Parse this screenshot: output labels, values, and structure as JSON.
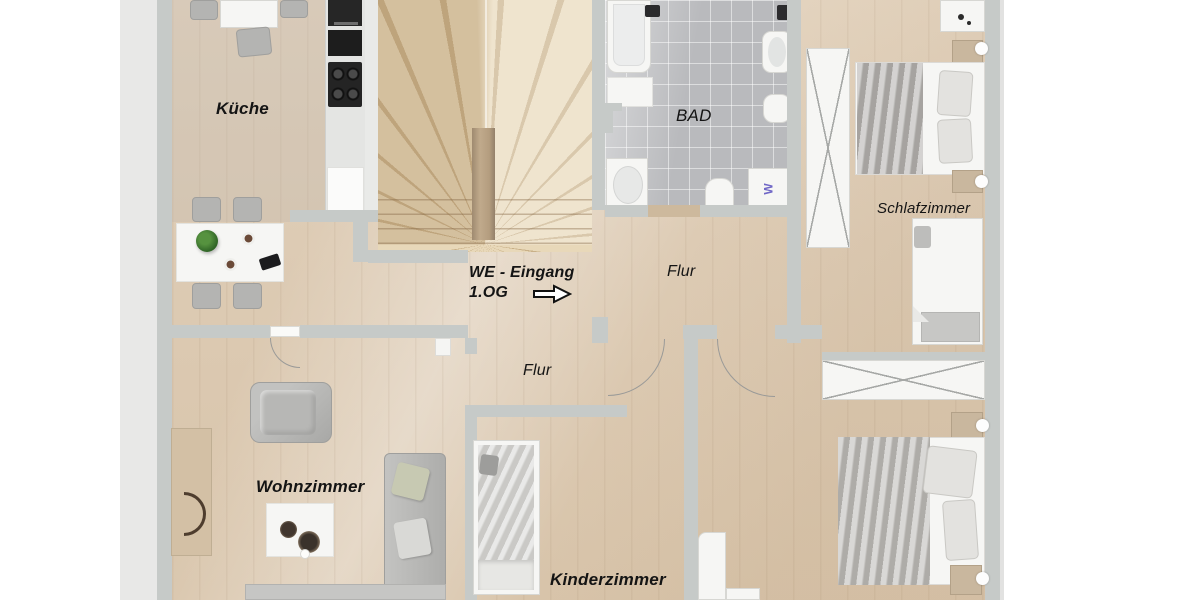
{
  "plan": {
    "type": "apartment-floor-plan",
    "labels": {
      "kueche": "Küche",
      "bad": "BAD",
      "flur_upper": "Flur",
      "flur_lower": "Flur",
      "schlafzimmer": "Schlafzimmer",
      "wohnzimmer": "Wohnzimmer",
      "kinderzimmer": "Kinderzimmer",
      "entrance_line1": "WE - Eingang",
      "entrance_line2": "1.OG",
      "washer_mark": "W"
    },
    "icons": {
      "entrance_arrow": "right-block-arrow",
      "wardrobe_front": "x-cross-doors",
      "door_swing": "quarter-circle-arc"
    },
    "colors": {
      "wall": "#c6cac8",
      "outer_band": "#e8e8e7",
      "wood_floor": "#ddccb6",
      "bath_tile": "#b9babd",
      "stair_tread": "#e2cfae",
      "label_text": "#141414",
      "washer_accent": "#6f66c6",
      "door_sill": "#cdb99d",
      "background": "#ffffff"
    }
  }
}
